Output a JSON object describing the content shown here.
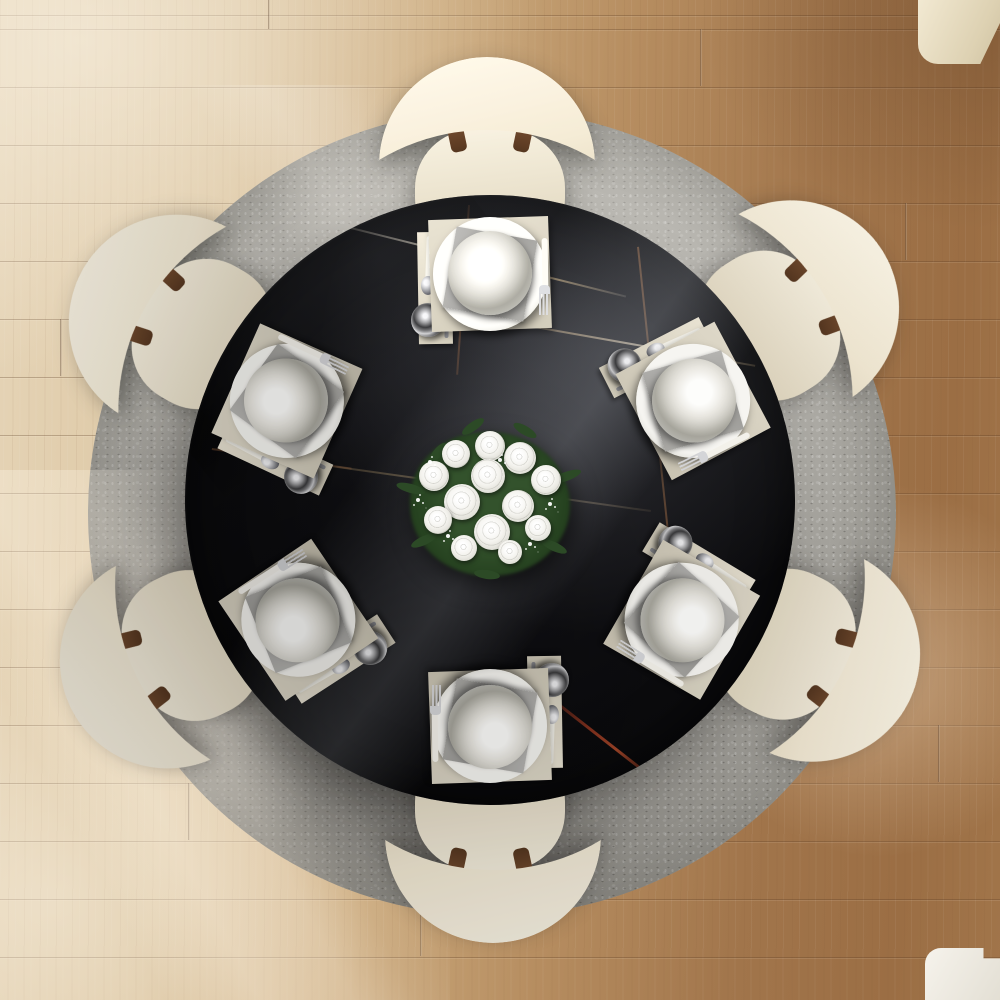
{
  "scene": {
    "setting": "Top-down view of a round dining room table set for six",
    "objects": [
      "round dining table",
      "round area rug",
      "six dining chairs",
      "six place settings",
      "white rose bouquet centerpiece",
      "oak plank floor",
      "corner furniture top right",
      "corner furniture bottom right"
    ],
    "table": {
      "shape": "round",
      "material": "black marble with thin veins",
      "top_color": "#0b0b0e",
      "vein_colors": {
        "gold": "#c9a36b",
        "copper": "#9a5f3a",
        "red": "#96371f",
        "white": "#e4dcc8"
      }
    },
    "rug": {
      "shape": "round",
      "texture": "mottled speckled weave",
      "color": "#98968f",
      "shadow_color": "#3e3b37"
    },
    "floor": {
      "material": "wood planks",
      "plank_direction": "horizontal",
      "light_color": "#e9dabd",
      "dark_color": "#9b6e44"
    },
    "chairs": {
      "count": 6,
      "style": "crescent curved backrest with round seat",
      "upholstery_color": "#efe8d7",
      "connector_color": "#6f4a31"
    },
    "place_settings": {
      "count": 6,
      "items": [
        "cutlery runner",
        "knife",
        "spoon",
        "tumbler glass",
        "placemat",
        "dinner plate",
        "grey napkin",
        "bowl",
        "fork"
      ],
      "placemat_color": "#d8d2c2",
      "napkin_color": "#9a9996",
      "plate_color": "#f2f1ed",
      "cutlery_handle_color": "#f2f0e8",
      "cutlery_metal_color": "#c4c4c6"
    },
    "centerpiece": {
      "type": "bouquet",
      "flower": "white roses",
      "rose_count": 13,
      "greenery_color": "#2c4a26",
      "accents": "baby's breath"
    },
    "lighting": {
      "source": "window light from upper left",
      "effects": [
        "diagonal light streaks on rug and floor",
        "glossy sheen on tabletop",
        "bright pool on lower right floor"
      ]
    }
  }
}
